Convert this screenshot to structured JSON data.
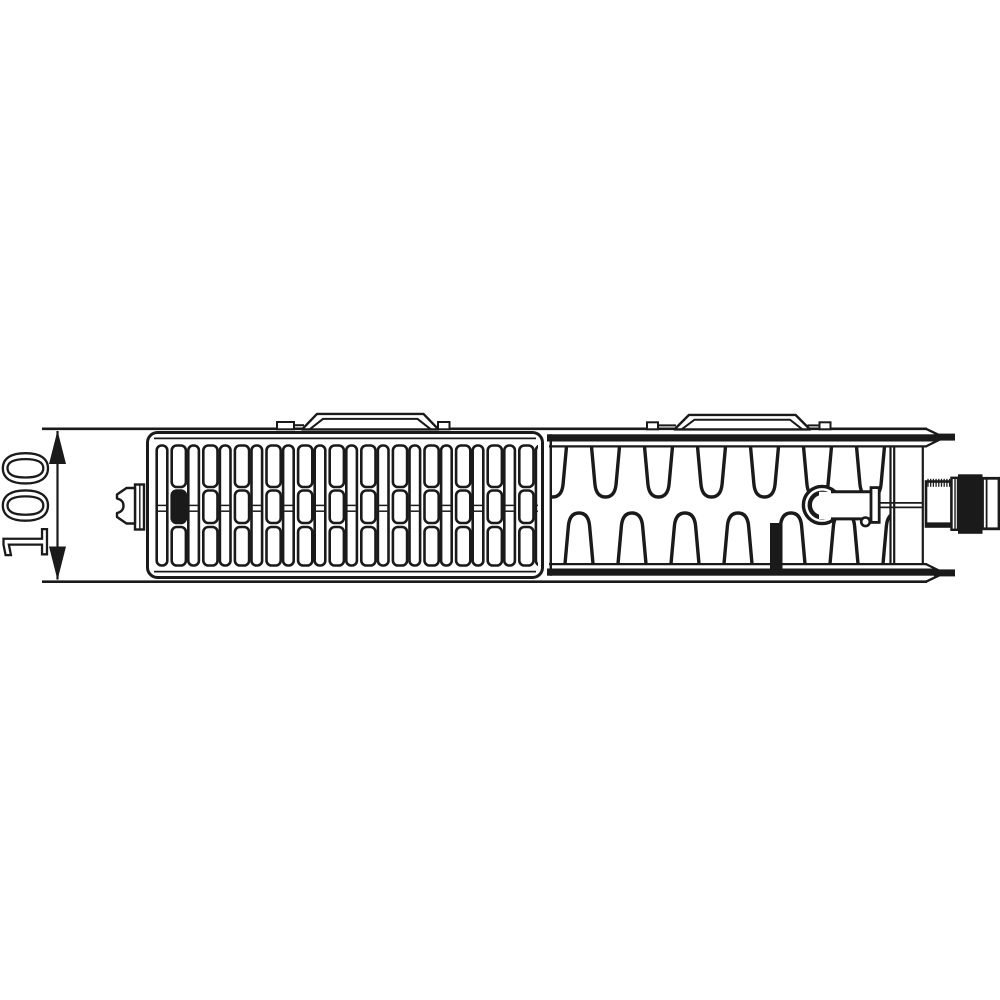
{
  "page": {
    "background": "#ffffff"
  },
  "drawing": {
    "type": "technical-line-drawing",
    "subject": "radiator-top-view-cross-section",
    "ink": "#1a1a1a",
    "paper": "#ffffff",
    "dimension": {
      "label": "100",
      "orientation": "vertical",
      "arrow_style": "double-headed-filled"
    },
    "components": {
      "grille_section": "slotted-top-grille",
      "fin_section": "convector-fins",
      "brackets": "two-top-mounting-clips",
      "left_part": "plug-cap",
      "right_parts": [
        "valve-body-ring",
        "valve-pipe",
        "spindle",
        "threaded-bush",
        "union-nut",
        "end-cap"
      ]
    },
    "grille": {
      "narrow_columns": 13,
      "wide_columns": 12,
      "pitch": 31.6,
      "filled_slot_wide_column": 0
    },
    "fins": {
      "top_count": 7,
      "bottom_count": 7,
      "pitch": 53,
      "first_top_center_x": 552.5,
      "bottom_offset": 26.5
    }
  }
}
